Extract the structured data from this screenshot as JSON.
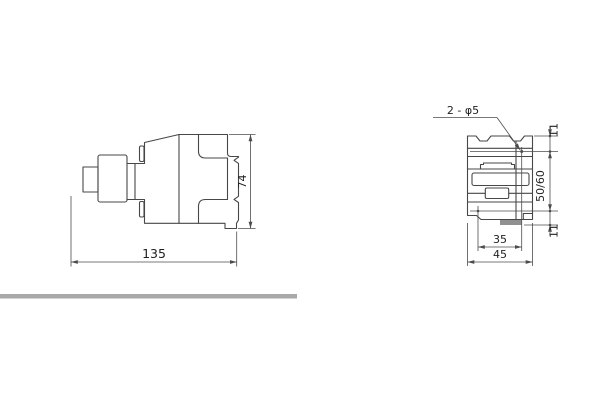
{
  "drawing": {
    "kind": "technical dimension drawing, two orthographic views of a contactor",
    "side_view": {
      "width_label": "135",
      "height_label": "74"
    },
    "front_view": {
      "holes_callout": "2 - φ5",
      "top_offset_label": "11",
      "rail_spacing_label": "50/60",
      "bottom_offset_label": "11",
      "hole_span_label": "35",
      "width_label": "45"
    },
    "colors": {
      "outline": "#474747",
      "dimension": "#4c4c4c",
      "text": "#1f1f1f",
      "separator_bar": "#a9a9a9",
      "foot_tab_fill": "#909090"
    }
  }
}
